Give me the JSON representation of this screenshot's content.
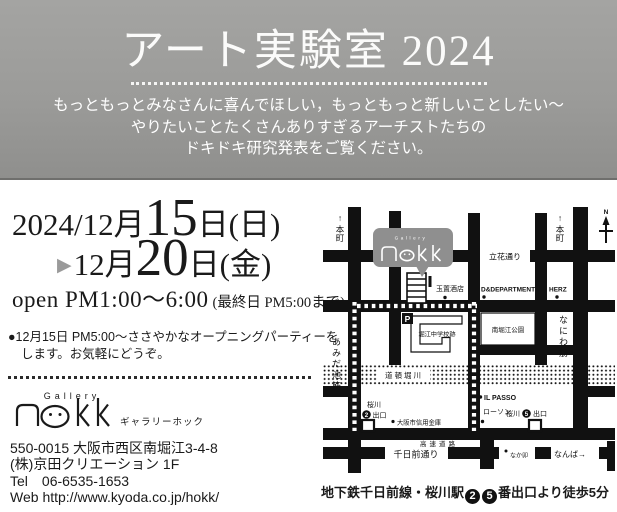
{
  "banner": {
    "title": "アート実験室 2024",
    "subtitle_lines": [
      "もっともっとみなさんに喜んでほしい，もっともっと新しいことしたい～",
      "やりたいことたくさんありすぎるアーチストたちの",
      "ドキドキ研究発表をご覧ください。"
    ]
  },
  "dates": {
    "line1_prefix": "2024/12月",
    "line1_day": "15",
    "line1_suffix": "日(日)",
    "arrow": "▶",
    "line2_prefix": "12月",
    "line2_day": "20",
    "line2_suffix": "日(金)",
    "open_main": "open PM1:00～6:00",
    "open_note": "(最終日 PM5:00まで)",
    "party_line1": "●12月15日 PM5:00～ささやかなオープニングパーティーを",
    "party_line2": "します。お気軽にどうぞ。"
  },
  "gallery": {
    "name_en": "Gallery",
    "name_kana": "ギャラリーホック",
    "address": "550-0015 大阪市西区南堀江3-4-8",
    "building": "(株)京田クリエーション 1F",
    "tel_label": "Tel",
    "tel_number": "06-6535-1653",
    "web_label": "Web",
    "web_url": "http://www.kyoda.co.jp/hokk/"
  },
  "map": {
    "up_arrow": "↑",
    "hommachi": "本町",
    "north": "N",
    "tachibana_st": "立花通り",
    "gallery_en": "Gallery",
    "tamaki_sake": "玉置酒店",
    "dd_store": "D&DEPARTMENT",
    "herz": "HERZ",
    "amidaike_st": "あみだ池筋",
    "naniwa_st": "なにわ筋",
    "school_site": "堀江中学校跡",
    "park": "南堀江公園",
    "parking": "P",
    "river": "道頓堀川",
    "il_passo": "IL PASSO",
    "lawson": "ローソン",
    "sakuragawa": "桜川",
    "exit_label": "出口",
    "exit2": "2",
    "exit5": "5",
    "shinkin_bank": "大阪市信用金庫",
    "highway": "高速道路",
    "sennichimae_st": "千日前通り",
    "nakau": "なか卯",
    "namba_arrow": "なんば→"
  },
  "caption": {
    "prefix": "地下鉄千日前線・桜川駅",
    "exit2": "2",
    "exit5": "5",
    "suffix": "番出口より徒歩5分"
  },
  "colors": {
    "banner_gray": "#9b9b99",
    "street_black": "#111111",
    "bubble_gray": "#8f8f8f",
    "arrow_gray": "#9a9a9a"
  }
}
